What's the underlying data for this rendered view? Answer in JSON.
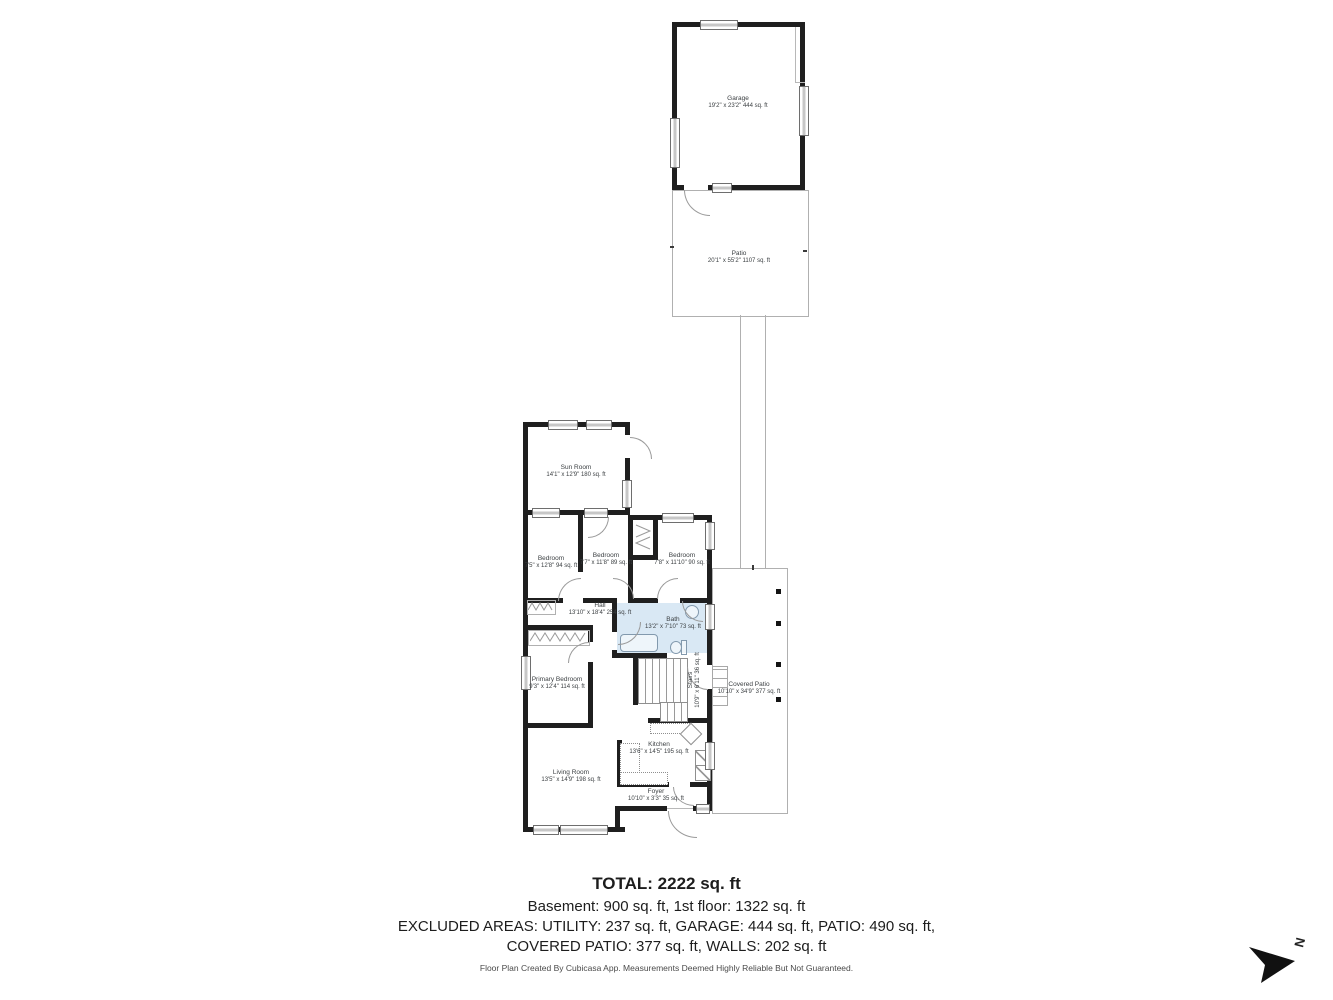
{
  "rooms": {
    "garage": {
      "name": "Garage",
      "dims": "19'2\" x 23'2\" 444 sq. ft"
    },
    "patio": {
      "name": "Patio",
      "dims": "20'1\" x 55'2\" 1107 sq. ft"
    },
    "sun_room": {
      "name": "Sun Room",
      "dims": "14'1\" x 12'9\" 180 sq. ft"
    },
    "bedroom_left": {
      "name": "Bedroom",
      "dims": "7'5\" x 12'8\" 94 sq. ft"
    },
    "bedroom_middle": {
      "name": "Bedroom",
      "dims": "7'7\" x 11'8\" 89 sq. ft"
    },
    "bedroom_right": {
      "name": "Bedroom",
      "dims": "7'8\" x 11'10\" 90 sq. ft"
    },
    "hall": {
      "name": "Hall",
      "dims": "13'10\" x 18'4\" 254 sq. ft"
    },
    "bath": {
      "name": "Bath",
      "dims": "13'2\" x 7'10\" 73 sq. ft"
    },
    "primary_bedroom": {
      "name": "Primary Bedroom",
      "dims": "9'3\" x 12'4\" 114 sq. ft"
    },
    "stairs": {
      "name": "Stairs",
      "dims": "10'9\" x 6'11\" 36 sq. ft"
    },
    "covered_patio": {
      "name": "Covered Patio",
      "dims": "10'10\" x 34'9\" 377 sq. ft"
    },
    "kitchen": {
      "name": "Kitchen",
      "dims": "13'6\" x 14'5\" 195 sq. ft"
    },
    "living_room": {
      "name": "Living Room",
      "dims": "13'5\" x 14'9\" 198 sq. ft"
    },
    "foyer": {
      "name": "Foyer",
      "dims": "10'10\" x 3'3\" 35 sq. ft"
    }
  },
  "summary": {
    "total": "TOTAL: 2222 sq. ft",
    "floors": "Basement: 900 sq. ft, 1st floor: 1322 sq. ft",
    "excluded_line1": "EXCLUDED AREAS: UTILITY: 237 sq. ft, GARAGE: 444 sq. ft, PATIO: 490 sq. ft,",
    "excluded_line2": "COVERED PATIO: 377 sq. ft, WALLS: 202 sq. ft"
  },
  "footer": {
    "disclaimer": "Floor Plan Created By Cubicasa App. Measurements Deemed Highly Reliable But Not Guaranteed."
  },
  "compass": {
    "north_label": "N"
  },
  "colors": {
    "wall": "#1f1f1f",
    "bath_fill": "#d9e8f4",
    "outline_gray": "#b0b0b0",
    "text_gray": "#3c4043"
  }
}
